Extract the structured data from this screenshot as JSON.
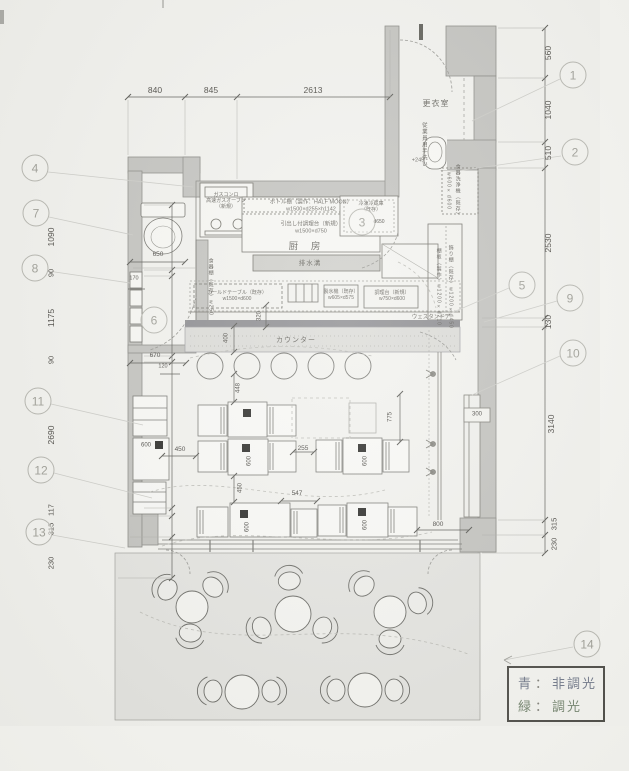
{
  "meta": {
    "type": "architectural floor plan (scanned)",
    "language": "ja"
  },
  "legend": {
    "sep": "：",
    "rows": [
      {
        "key": "青",
        "value": "非調光"
      },
      {
        "key": "緑",
        "value": "調光"
      }
    ]
  },
  "room_labels": [
    {
      "id": "label-changing-room",
      "t": "更衣室",
      "x": 436,
      "y": 104,
      "fs": 8,
      "ls": 1
    },
    {
      "id": "label-kitchen",
      "t": "厨 房",
      "x": 307,
      "y": 247,
      "fs": 9.5,
      "ls": 5
    },
    {
      "id": "label-drain",
      "t": "排水溝",
      "x": 310,
      "y": 264,
      "fs": 6.5,
      "ls": 1
    },
    {
      "id": "label-counter",
      "t": "カウンター",
      "x": 296,
      "y": 341,
      "fs": 7,
      "ls": 1
    },
    {
      "id": "label-western-door",
      "t": "ウェスタンドア",
      "x": 431,
      "y": 318,
      "fs": 5.5,
      "ls": 0
    }
  ],
  "equipment_labels": [
    {
      "id": "label-gas-stove",
      "lines": [
        "ガスコンロ",
        "高速ガスオーブン",
        "（新規）"
      ],
      "x": 226,
      "y": 201,
      "fs": 5
    },
    {
      "id": "label-bottle-shelf",
      "lines": [
        "ボトル棚（製作：HALF MOON）",
        "w1500×d255×h1142"
      ],
      "x": 311,
      "y": 206,
      "fs": 5.5
    },
    {
      "id": "label-prep-drawer",
      "lines": [
        "引出し付調理台（新規）",
        "w1500×d750"
      ],
      "x": 311,
      "y": 228,
      "fs": 5.5
    },
    {
      "id": "label-fridge",
      "lines": [
        "冷凍冷蔵庫",
        "（既存）"
      ],
      "x": 371,
      "y": 207,
      "fs": 5
    },
    {
      "id": "label-cold-table",
      "lines": [
        "コールドテーブル（既存）",
        "w1500×d600"
      ],
      "x": 237,
      "y": 296,
      "fs": 5
    },
    {
      "id": "label-ice-machine",
      "lines": [
        "製氷機（既存）",
        "w605×d575"
      ],
      "x": 341,
      "y": 295,
      "fs": 5
    },
    {
      "id": "label-prep-table",
      "lines": [
        "調理台（新規）",
        "w750×d600"
      ],
      "x": 392,
      "y": 296,
      "fs": 5
    },
    {
      "id": "label-floor-level",
      "lines": [
        "+245"
      ],
      "x": 418,
      "y": 161,
      "fs": 5.5
    }
  ],
  "vertical_labels": [
    {
      "id": "label-employee-sink",
      "t": "従業員用手洗い",
      "x": 423,
      "y": 145,
      "fs": 5.5
    },
    {
      "id": "label-dishwasher-name",
      "t": "食器洗浄機（既存）",
      "x": 457,
      "y": 191,
      "fs": 5
    },
    {
      "id": "label-dishwasher-size",
      "t": "w600×d600",
      "x": 448,
      "y": 191,
      "fs": 5
    },
    {
      "id": "label-wall-shelf-a",
      "t": "飾り棚（既存）w1200×d450",
      "x": 450,
      "y": 287,
      "fs": 5
    },
    {
      "id": "label-wall-shelf-b",
      "t": "棚板（製作）w1200×d210",
      "x": 438,
      "y": 287,
      "fs": 5
    },
    {
      "id": "label-toilet-shelf",
      "t": "食器棚（既存）w250",
      "x": 210,
      "y": 287,
      "fs": 5
    }
  ],
  "dim_labels": [
    {
      "t": "840",
      "x": 155,
      "y": 90,
      "fs": 8.5
    },
    {
      "t": "845",
      "x": 211,
      "y": 90,
      "fs": 8.5
    },
    {
      "t": "2613",
      "x": 313,
      "y": 90,
      "fs": 8.5
    },
    {
      "t": "560",
      "x": 548,
      "y": 53,
      "fs": 8.5,
      "rot": true
    },
    {
      "t": "1040",
      "x": 548,
      "y": 110,
      "fs": 8.5,
      "rot": true
    },
    {
      "t": "510",
      "x": 548,
      "y": 153,
      "fs": 8.5,
      "rot": true
    },
    {
      "t": "2530",
      "x": 548,
      "y": 243,
      "fs": 8.5,
      "rot": true
    },
    {
      "t": "130",
      "x": 548,
      "y": 322,
      "fs": 8.5,
      "rot": true
    },
    {
      "t": "3140",
      "x": 551,
      "y": 424,
      "fs": 8.5,
      "rot": true
    },
    {
      "t": "315",
      "x": 554,
      "y": 524,
      "fs": 7.5,
      "rot": true
    },
    {
      "t": "230",
      "x": 554,
      "y": 544,
      "fs": 7.5,
      "rot": true
    },
    {
      "t": "1090",
      "x": 51,
      "y": 237,
      "fs": 8.5,
      "rot": true
    },
    {
      "t": "90",
      "x": 51,
      "y": 273,
      "fs": 7.5,
      "rot": true
    },
    {
      "t": "1175",
      "x": 51,
      "y": 318,
      "fs": 8.5,
      "rot": true
    },
    {
      "t": "90",
      "x": 51,
      "y": 360,
      "fs": 7.5,
      "rot": true
    },
    {
      "t": "2690",
      "x": 51,
      "y": 435,
      "fs": 8.5,
      "rot": true
    },
    {
      "t": "117",
      "x": 51,
      "y": 510,
      "fs": 7.5,
      "rot": true
    },
    {
      "t": "315",
      "x": 51,
      "y": 529,
      "fs": 7.5,
      "rot": true
    },
    {
      "t": "230",
      "x": 51,
      "y": 563,
      "fs": 7.5,
      "rot": true
    },
    {
      "t": "650",
      "x": 158,
      "y": 255,
      "fs": 6.5
    },
    {
      "t": "170",
      "x": 134,
      "y": 279,
      "fs": 5.5
    },
    {
      "t": "670",
      "x": 155,
      "y": 356,
      "fs": 6.5
    },
    {
      "t": "120",
      "x": 163,
      "y": 367,
      "fs": 5.5
    },
    {
      "t": "320",
      "x": 260,
      "y": 316,
      "fs": 6,
      "rot": true
    },
    {
      "t": "400",
      "x": 227,
      "y": 338,
      "fs": 6,
      "rot": true
    },
    {
      "t": "448",
      "x": 239,
      "y": 388,
      "fs": 6,
      "rot": true
    },
    {
      "t": "450",
      "x": 180,
      "y": 450,
      "fs": 6.5
    },
    {
      "t": "255",
      "x": 303,
      "y": 449,
      "fs": 6.5
    },
    {
      "t": "450",
      "x": 241,
      "y": 488,
      "fs": 6,
      "rot": true
    },
    {
      "t": "547",
      "x": 297,
      "y": 494,
      "fs": 6.5
    },
    {
      "t": "800",
      "x": 438,
      "y": 525,
      "fs": 6.5
    },
    {
      "t": "775",
      "x": 391,
      "y": 417,
      "fs": 6,
      "rot": true
    },
    {
      "t": "300",
      "x": 477,
      "y": 415,
      "fs": 6
    },
    {
      "t": "d650",
      "x": 379,
      "y": 222,
      "fs": 5
    },
    {
      "t": "600",
      "x": 146,
      "y": 446,
      "fs": 6
    },
    {
      "t": "600",
      "x": 250,
      "y": 461,
      "fs": 6,
      "rot": true
    },
    {
      "t": "600",
      "x": 366,
      "y": 461,
      "fs": 6,
      "rot": true
    },
    {
      "t": "600",
      "x": 248,
      "y": 527,
      "fs": 6,
      "rot": true
    },
    {
      "t": "600",
      "x": 366,
      "y": 525,
      "fs": 6,
      "rot": true
    }
  ],
  "black_squares": [
    {
      "x": 159,
      "y": 445,
      "s": 8
    },
    {
      "x": 247,
      "y": 413,
      "s": 8
    },
    {
      "x": 246,
      "y": 448,
      "s": 8
    },
    {
      "x": 362,
      "y": 448,
      "s": 8
    },
    {
      "x": 244,
      "y": 514,
      "s": 8
    },
    {
      "x": 362,
      "y": 512,
      "s": 8
    }
  ],
  "callouts": [
    {
      "n": "1",
      "x": 573,
      "y": 75
    },
    {
      "n": "2",
      "x": 575,
      "y": 152
    },
    {
      "n": "3",
      "x": 362,
      "y": 222
    },
    {
      "n": "4",
      "x": 35,
      "y": 168
    },
    {
      "n": "5",
      "x": 522,
      "y": 285
    },
    {
      "n": "6",
      "x": 154,
      "y": 320
    },
    {
      "n": "7",
      "x": 36,
      "y": 213
    },
    {
      "n": "8",
      "x": 35,
      "y": 268
    },
    {
      "n": "9",
      "x": 570,
      "y": 298
    },
    {
      "n": "10",
      "x": 573,
      "y": 353
    },
    {
      "n": "11",
      "x": 38,
      "y": 401
    },
    {
      "n": "12",
      "x": 41,
      "y": 470
    },
    {
      "n": "13",
      "x": 39,
      "y": 532
    },
    {
      "n": "14",
      "x": 587,
      "y": 644
    }
  ]
}
